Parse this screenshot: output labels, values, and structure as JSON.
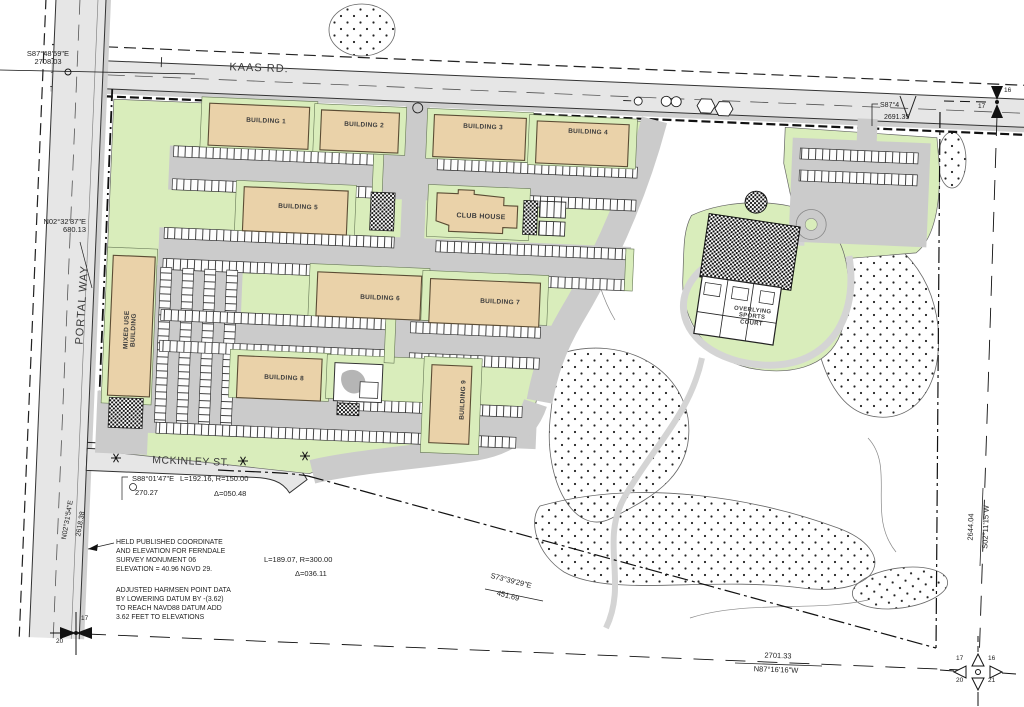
{
  "roads": {
    "kaas": "KAAS RD.",
    "portal": "PORTAL WAY",
    "mckinley": "MCKINLEY ST."
  },
  "buildings": {
    "b1": "BUILDING 1",
    "b2": "BUILDING 2",
    "b3": "BUILDING 3",
    "b4": "BUILDING 4",
    "b5": "BUILDING 5",
    "b6": "BUILDING 6",
    "b7": "BUILDING 7",
    "b8": "BUILDING 8",
    "b9": "BUILDING 9",
    "club": "CLUB HOUSE",
    "mixed_line1": "MIXED USE",
    "mixed_line2": "BUILDING",
    "court_line1": "OVERLYING",
    "court_line2": "SPORTS",
    "court_line3": "COURT"
  },
  "annotations": {
    "nw_bearing": "S87°48'59\"E",
    "nw_dist": "2708.03",
    "w_bearing": "N02°32'37\"E",
    "w_dist": "680.13",
    "sw_bearing": "N02°31'54\"E",
    "sw_dist": "2618.38",
    "mck_bearing": "S88°01'47\"E",
    "mck_curve": "L=192.16, R=150.00",
    "mck_dist": "270.27",
    "mck_delta": "Δ=050.48",
    "s_curve": "L=189.07, R=300.00",
    "s_delta": "Δ=036.11",
    "se_bearing": "S73°39'29\"E",
    "se_dist": "451.69",
    "s_section_dist": "2701.33",
    "s_section_bearing": "N87°16'16\"W",
    "e_section_dist": "2644.04",
    "e_section_bearing": "S02°11'15\"W",
    "ne_bearing_partial": "S87°4",
    "ne_dist": "2691.35"
  },
  "notes": {
    "note1": "HELD PUBLISHED COORDINATE\nAND ELEVATION FOR FERNDALE\nSURVEY MONUMENT 06\nELEVATION = 40.96 NGVD 29.",
    "note2": "ADJUSTED HARMSEN POINT DATA\nBY LOWERING DATUM BY  -(3.62)\nTO REACH NAVD88 DATUM ADD\n3.62 FEET TO ELEVATIONS"
  },
  "corners": {
    "ne_16": "16",
    "ne_17": "17",
    "se_17": "17",
    "se_16": "16",
    "se_20": "20",
    "se_21": "21",
    "sw_17": "17",
    "sw_20": "20"
  },
  "colors": {
    "building_tan": "#ead2a9",
    "landscape_green": "#d9edbb",
    "pavement_gray": "#cbcbcb",
    "road_gray": "#e6e6e6"
  }
}
